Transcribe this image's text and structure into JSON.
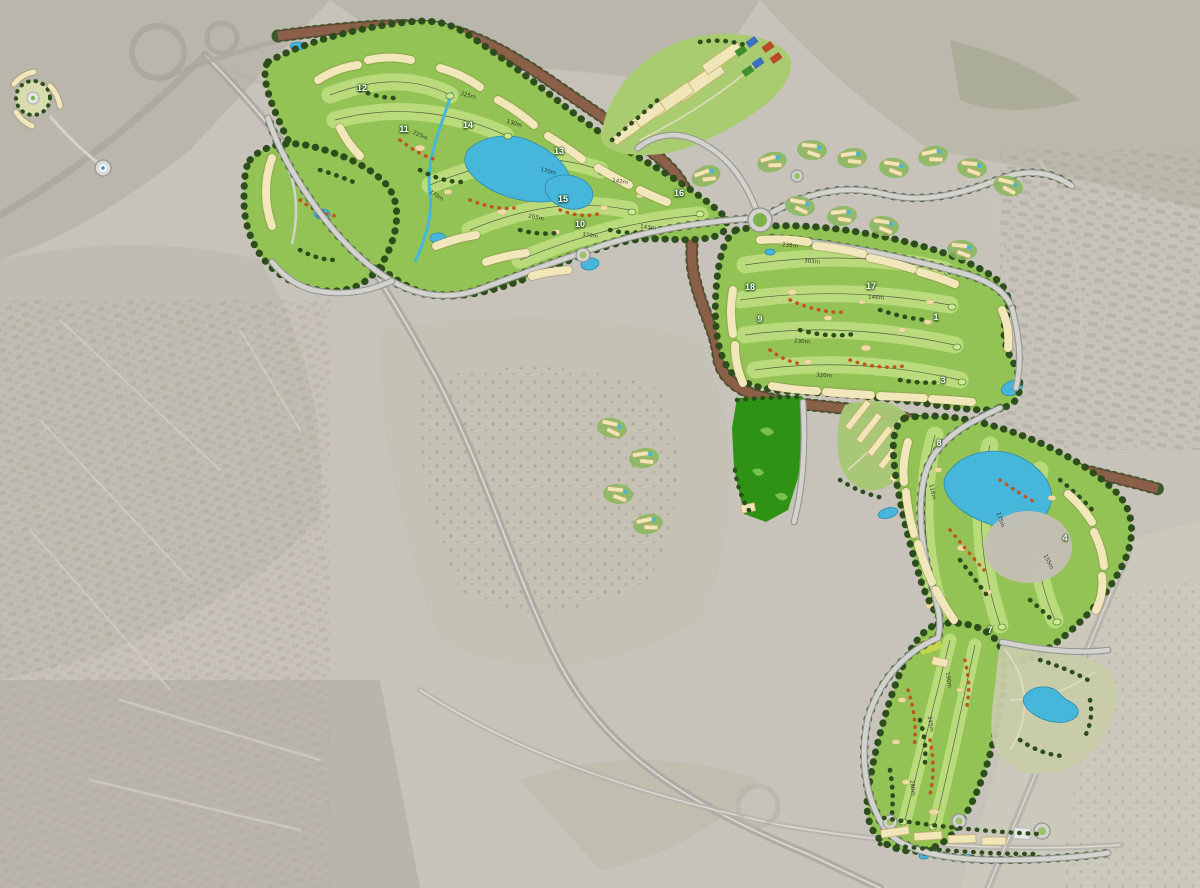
{
  "map": {
    "description": "Aerial satellite photograph of a coastal town, faded, with a saturated golf-resort masterplan rendering overlaid: three golf course areas with numbered holes, cream residential building rows, lakes, a brown landscaped avenue, sports courts and parks",
    "palette": {
      "satellite_base": "#c7c3ba",
      "satellite_urban": "#b3afa4",
      "satellite_vegetation": "#9da285",
      "fairway_base": "#93c255",
      "fairway_light": "#bcdc7e",
      "tree_dark_green": "#2d4e1c",
      "tree_accent_orange": "#c0551e",
      "building_cream": "#f1e6b8",
      "water_blue": "#47b6db",
      "avenue_brown": "#8a6048",
      "road_gray": "#d2d2cf",
      "event_field_green": "#2e9314",
      "court_blue": "#3a6fc0",
      "court_red": "#b84a28",
      "court_green": "#3f8f2f"
    },
    "hole_markers": [
      {
        "number": "12",
        "x": 362,
        "y": 88
      },
      {
        "number": "11",
        "x": 404,
        "y": 129
      },
      {
        "number": "14",
        "x": 468,
        "y": 125
      },
      {
        "number": "13",
        "x": 559,
        "y": 151
      },
      {
        "number": "15",
        "x": 563,
        "y": 199
      },
      {
        "number": "10",
        "x": 580,
        "y": 224
      },
      {
        "number": "16",
        "x": 679,
        "y": 193
      },
      {
        "number": "18",
        "x": 750,
        "y": 287
      },
      {
        "number": "17",
        "x": 871,
        "y": 286
      },
      {
        "number": "9",
        "x": 760,
        "y": 319
      },
      {
        "number": "1",
        "x": 936,
        "y": 317
      },
      {
        "number": "3",
        "x": 943,
        "y": 380
      },
      {
        "number": "8",
        "x": 939,
        "y": 443
      },
      {
        "number": "4",
        "x": 1065,
        "y": 538
      },
      {
        "number": "7",
        "x": 990,
        "y": 630
      }
    ],
    "distance_labels": [
      {
        "text": "325m",
        "x": 468,
        "y": 96,
        "r": 14
      },
      {
        "text": "130m",
        "x": 514,
        "y": 124,
        "r": 18
      },
      {
        "text": "225m",
        "x": 420,
        "y": 136,
        "r": 25
      },
      {
        "text": "170m",
        "x": 548,
        "y": 172,
        "r": 14
      },
      {
        "text": "370m",
        "x": 436,
        "y": 196,
        "r": 32
      },
      {
        "text": "142m",
        "x": 620,
        "y": 182,
        "r": 8
      },
      {
        "text": "205m",
        "x": 536,
        "y": 218,
        "r": 12
      },
      {
        "text": "370m",
        "x": 590,
        "y": 236,
        "r": 8
      },
      {
        "text": "143m",
        "x": 648,
        "y": 228,
        "r": 6
      },
      {
        "text": "303m",
        "x": 812,
        "y": 262,
        "r": 6
      },
      {
        "text": "235m",
        "x": 790,
        "y": 246,
        "r": 5
      },
      {
        "text": "146m",
        "x": 876,
        "y": 298,
        "r": 4
      },
      {
        "text": "230m",
        "x": 802,
        "y": 342,
        "r": 5
      },
      {
        "text": "320m",
        "x": 824,
        "y": 376,
        "r": 4
      },
      {
        "text": "118m",
        "x": 932,
        "y": 492,
        "r": 78
      },
      {
        "text": "175m",
        "x": 1000,
        "y": 520,
        "r": 72
      },
      {
        "text": "155m",
        "x": 1048,
        "y": 562,
        "r": 64
      },
      {
        "text": "190m",
        "x": 948,
        "y": 680,
        "r": 80
      },
      {
        "text": "345m",
        "x": 930,
        "y": 724,
        "r": 82
      },
      {
        "text": "280m",
        "x": 912,
        "y": 788,
        "r": 84
      }
    ]
  }
}
